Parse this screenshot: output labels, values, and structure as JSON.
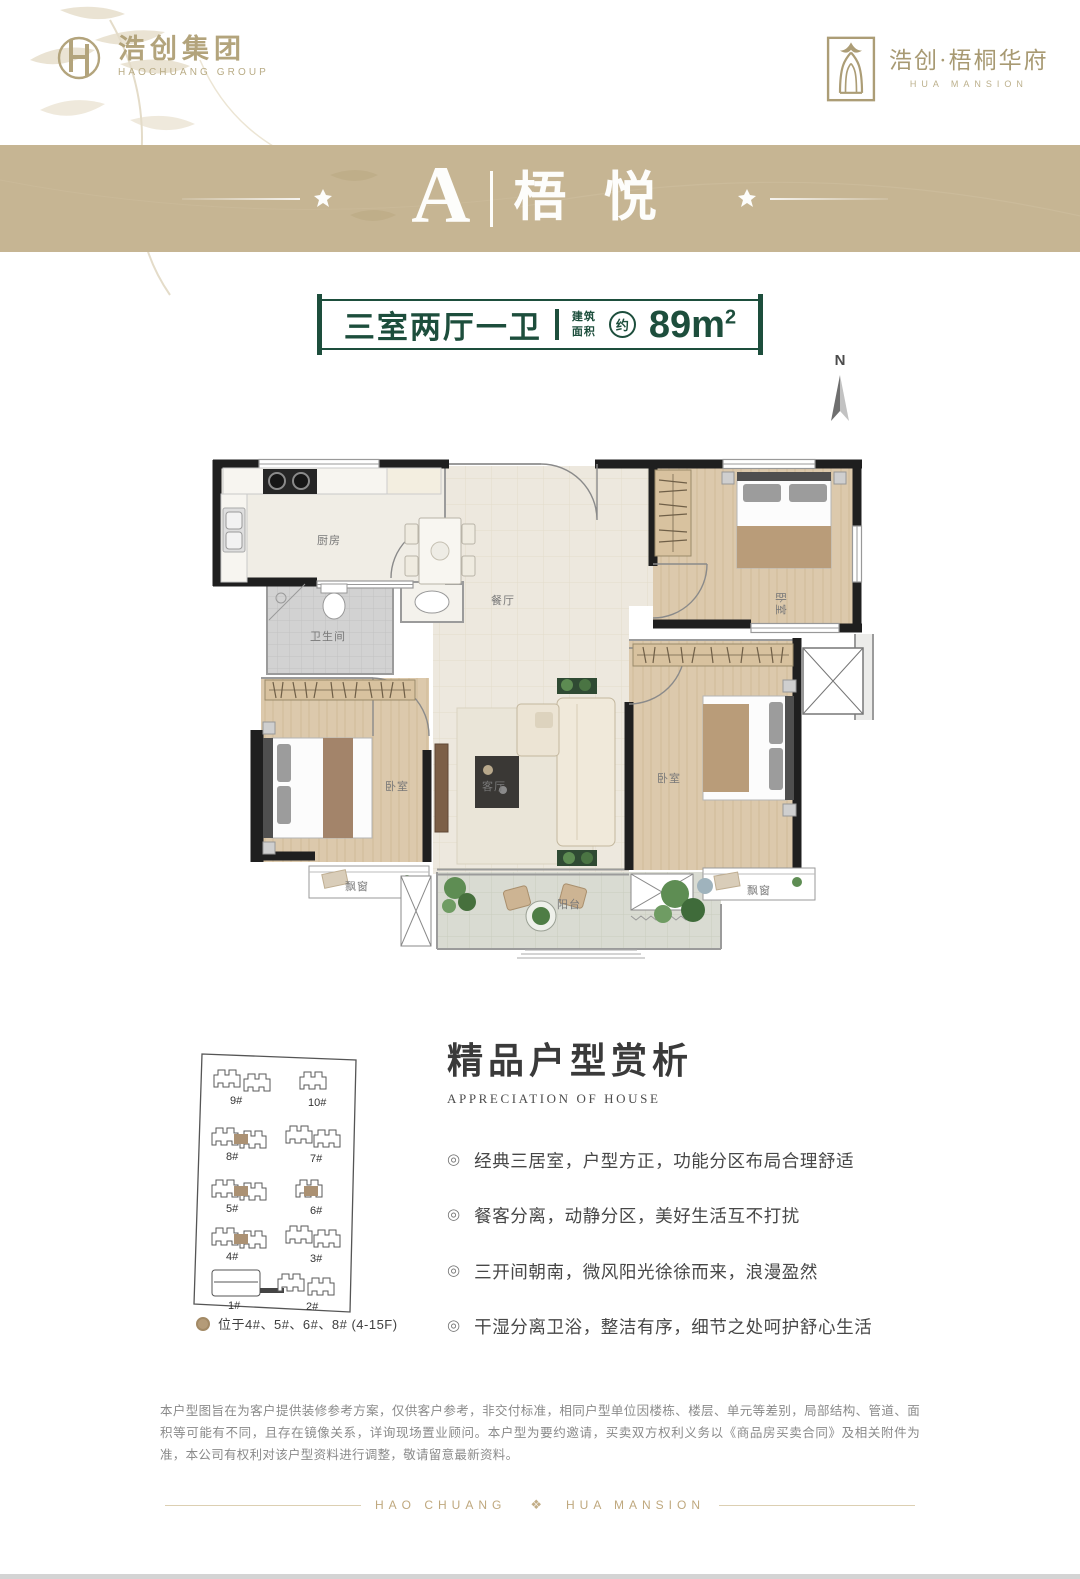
{
  "header": {
    "group_logo": {
      "name": "浩创集团",
      "subtitle": "HAOCHUANG GROUP"
    },
    "project_logo": {
      "name": "浩创·梧桐华府",
      "subtitle": "HUA MANSION"
    }
  },
  "banner": {
    "unit_letter": "A",
    "unit_name": "梧 悦"
  },
  "spec_badge": {
    "layout": "三室两厅一卫",
    "area_label_line1": "建筑",
    "area_label_line2": "面积",
    "approx": "约",
    "area_value": "89m",
    "area_sup": "2"
  },
  "compass": {
    "label": "N"
  },
  "floorplan": {
    "rooms": {
      "kitchen": "厨房",
      "dining": "餐厅",
      "bathroom": "卫生间",
      "bedroom_top": "卧室",
      "bedroom_left": "卧室",
      "bedroom_right": "卧室",
      "living": "客厅",
      "balcony": "阳台",
      "bay_left": "飘窗",
      "bay_right": "飘窗"
    }
  },
  "siteplan": {
    "buildings": [
      "9#",
      "10#",
      "8#",
      "7#",
      "5#",
      "6#",
      "4#",
      "3#",
      "1#",
      "2#"
    ],
    "legend": "位于4#、5#、6#、8# (4-15F)"
  },
  "appreciation": {
    "title": "精品户型赏析",
    "subtitle": "APPRECIATION OF HOUSE",
    "bullet_icon": "◎",
    "bullets": [
      "经典三居室，户型方正，功能分区布局合理舒适",
      "餐客分离，动静分区，美好生活互不打扰",
      "三开间朝南，微风阳光徐徐而来，浪漫盈然",
      "干湿分离卫浴，整洁有序，细节之处呵护舒心生活"
    ]
  },
  "disclaimer": "本户型图旨在为客户提供装修参考方案，仅供客户参考，非交付标准，相同户型单位因楼栋、楼层、单元等差别，局部结构、管道、面积等可能有不同，且存在镜像关系，详询现场置业顾问。本户型为要约邀请，买卖双方权利义务以《商品房买卖合同》及相关附件为准，本公司有权利对该户型资料进行调整，敬请留意最新资料。",
  "footer": {
    "left": "HAO CHUANG",
    "right": "HUA MANSION",
    "ornament": "❖"
  },
  "colors": {
    "banner_tan": "#c6b593",
    "badge_green": "#1d4e3c",
    "brand_gold": "#b3a47c"
  }
}
